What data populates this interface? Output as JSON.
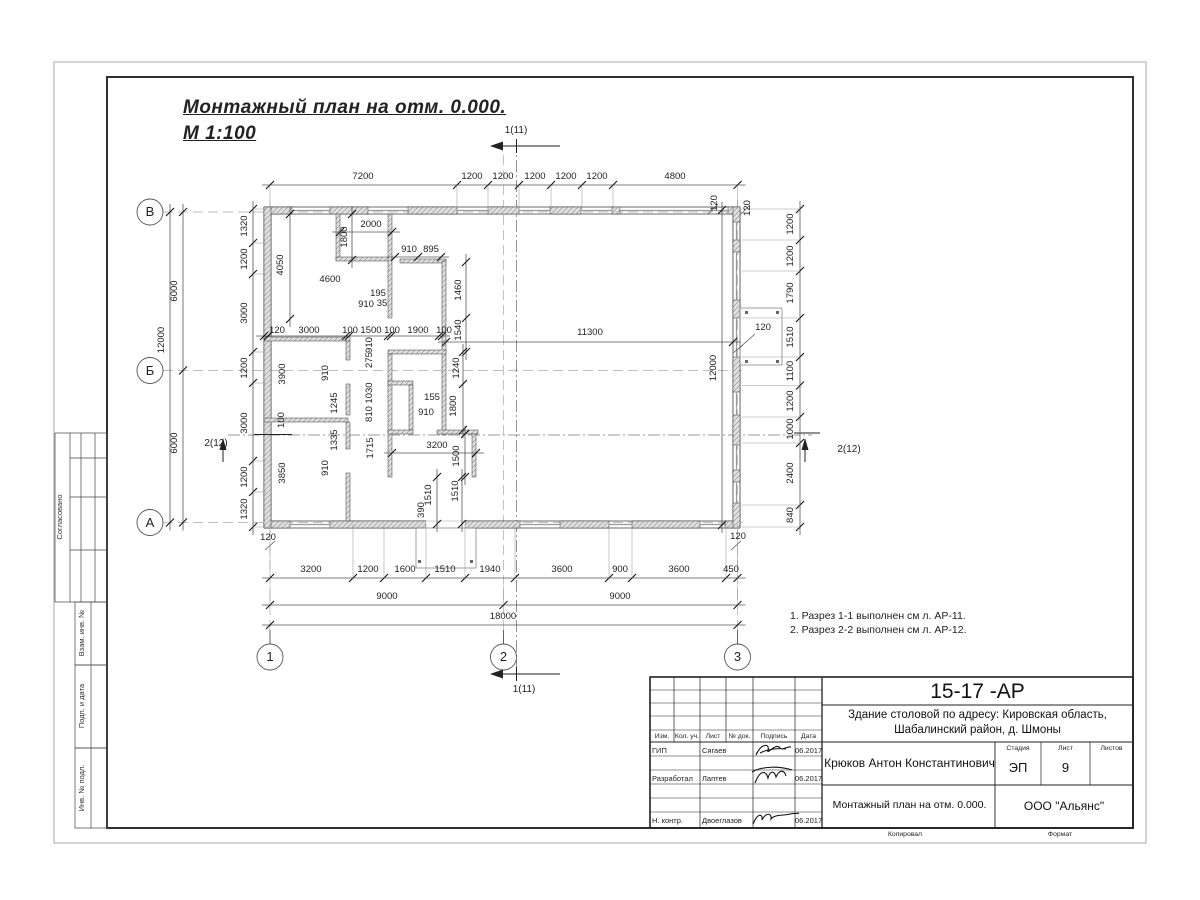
{
  "sheet": {
    "title": {
      "line1": "Монтажный план на отм. 0.000.",
      "line2": "М 1:100"
    },
    "notes": [
      "1. Разрез 1-1 выполнен см л. АР-11.",
      "2. Разрез 2-2 выполнен см л. АР-12."
    ],
    "side_labels": [
      "Согласовано",
      "Взам. инв. №",
      "Подп. и дата",
      "Инв. № подл."
    ],
    "stamp": {
      "code": "15-17 -АР",
      "object_line1": "Здание столовой по адресу: Кировская область,",
      "object_line2": "Шабалинский район, д. Шмоны",
      "person": "Крюков Антон Константинович",
      "doc_title": "Монтажный план на отм. 0.000.",
      "company": "ООО \"Альянс\"",
      "stage_label": "Стадия",
      "sheet_label": "Лист",
      "sheets_label": "Листов",
      "stage": "ЭП",
      "sheet_no": "9",
      "sheets": "",
      "cols": {
        "izm": "Изм.",
        "kol": "Кол. уч.",
        "list": "Лист",
        "doc": "№ док.",
        "sign": "Подпись",
        "date": "Дата"
      },
      "rows": [
        {
          "role": "ГИП",
          "name": "Сягаев",
          "date": "06.2017"
        },
        {
          "role": "Разработал",
          "name": "Лаптев",
          "date": "06.2017"
        },
        {
          "role": "Н. контр.",
          "name": "Двоеглазов",
          "date": "06.2017"
        }
      ],
      "kopiroval": "Копировал",
      "format": "Формат"
    }
  },
  "plan": {
    "colors": {
      "line": "#1a1a1a",
      "dim": "#444444",
      "wall_hatch": "#8a8a8a",
      "axis_dash": "#aaaaaa"
    },
    "labels": [
      {
        "t": "7200",
        "x": 363,
        "y": 179
      },
      {
        "t": "1200",
        "x": 472,
        "y": 179
      },
      {
        "t": "1200",
        "x": 503,
        "y": 179
      },
      {
        "t": "1200",
        "x": 535,
        "y": 179
      },
      {
        "t": "1200",
        "x": 566,
        "y": 179
      },
      {
        "t": "1200",
        "x": 597,
        "y": 179
      },
      {
        "t": "4800",
        "x": 675,
        "y": 179
      },
      {
        "t": "120",
        "x": 717,
        "y": 203,
        "r": -90
      },
      {
        "t": "120",
        "x": 750,
        "y": 208,
        "r": -90
      },
      {
        "t": "3200",
        "x": 311,
        "y": 572
      },
      {
        "t": "1200",
        "x": 368,
        "y": 572
      },
      {
        "t": "1600",
        "x": 405,
        "y": 572
      },
      {
        "t": "1510",
        "x": 445,
        "y": 572
      },
      {
        "t": "1940",
        "x": 490,
        "y": 572
      },
      {
        "t": "3600",
        "x": 562,
        "y": 572
      },
      {
        "t": "900",
        "x": 620,
        "y": 572
      },
      {
        "t": "3600",
        "x": 679,
        "y": 572
      },
      {
        "t": "450",
        "x": 731,
        "y": 572
      },
      {
        "t": "9000",
        "x": 387,
        "y": 599
      },
      {
        "t": "9000",
        "x": 620,
        "y": 599
      },
      {
        "t": "18000",
        "x": 503,
        "y": 619
      },
      {
        "t": "1320",
        "x": 247,
        "y": 226,
        "r": -90
      },
      {
        "t": "1200",
        "x": 247,
        "y": 259,
        "r": -90
      },
      {
        "t": "3000",
        "x": 247,
        "y": 313,
        "r": -90
      },
      {
        "t": "1200",
        "x": 247,
        "y": 368,
        "r": -90
      },
      {
        "t": "3000",
        "x": 247,
        "y": 423,
        "r": -90
      },
      {
        "t": "1200",
        "x": 247,
        "y": 477,
        "r": -90
      },
      {
        "t": "1320",
        "x": 247,
        "y": 509,
        "r": -90
      },
      {
        "t": "6000",
        "x": 177,
        "y": 291,
        "r": -90
      },
      {
        "t": "12000",
        "x": 164,
        "y": 340,
        "r": -90
      },
      {
        "t": "6000",
        "x": 177,
        "y": 443,
        "r": -90
      },
      {
        "t": "1200",
        "x": 793,
        "y": 224,
        "r": -90
      },
      {
        "t": "1200",
        "x": 793,
        "y": 256,
        "r": -90
      },
      {
        "t": "1790",
        "x": 793,
        "y": 293,
        "r": -90
      },
      {
        "t": "1510",
        "x": 793,
        "y": 337,
        "r": -90
      },
      {
        "t": "1100",
        "x": 793,
        "y": 371,
        "r": -90
      },
      {
        "t": "1200",
        "x": 793,
        "y": 401,
        "r": -90
      },
      {
        "t": "1000",
        "x": 793,
        "y": 429,
        "r": -90
      },
      {
        "t": "2400",
        "x": 793,
        "y": 473,
        "r": -90
      },
      {
        "t": "840",
        "x": 793,
        "y": 515,
        "r": -90
      },
      {
        "t": "120",
        "x": 268,
        "y": 540
      },
      {
        "t": "120",
        "x": 738,
        "y": 539
      },
      {
        "t": "2000",
        "x": 371,
        "y": 227
      },
      {
        "t": "1800",
        "x": 347,
        "y": 237,
        "r": -90
      },
      {
        "t": "4050",
        "x": 283,
        "y": 265,
        "r": -90
      },
      {
        "t": "4600",
        "x": 330,
        "y": 282
      },
      {
        "t": "910",
        "x": 409,
        "y": 252
      },
      {
        "t": "895",
        "x": 431,
        "y": 252
      },
      {
        "t": "1460",
        "x": 461,
        "y": 290,
        "r": -90
      },
      {
        "t": "1540",
        "x": 461,
        "y": 330,
        "r": -90
      },
      {
        "t": "195",
        "x": 378,
        "y": 296
      },
      {
        "t": "910",
        "x": 366,
        "y": 307
      },
      {
        "t": "35",
        "x": 382,
        "y": 306
      },
      {
        "t": "120",
        "x": 277,
        "y": 333
      },
      {
        "t": "3000",
        "x": 309,
        "y": 333
      },
      {
        "t": "100",
        "x": 350,
        "y": 333
      },
      {
        "t": "1500",
        "x": 371,
        "y": 333
      },
      {
        "t": "100",
        "x": 392,
        "y": 333
      },
      {
        "t": "1900",
        "x": 418,
        "y": 333
      },
      {
        "t": "100",
        "x": 444,
        "y": 333
      },
      {
        "t": "11300",
        "x": 590,
        "y": 335
      },
      {
        "t": "12000",
        "x": 716,
        "y": 368,
        "r": -90
      },
      {
        "t": "120",
        "x": 763,
        "y": 330
      },
      {
        "t": "910",
        "x": 372,
        "y": 345,
        "r": -90
      },
      {
        "t": "275",
        "x": 372,
        "y": 360,
        "r": -90
      },
      {
        "t": "1030",
        "x": 372,
        "y": 393,
        "r": -90
      },
      {
        "t": "810",
        "x": 372,
        "y": 414,
        "r": -90
      },
      {
        "t": "1715",
        "x": 373,
        "y": 448,
        "r": -90
      },
      {
        "t": "3900",
        "x": 285,
        "y": 374,
        "r": -90
      },
      {
        "t": "910",
        "x": 328,
        "y": 373,
        "r": -90
      },
      {
        "t": "1245",
        "x": 337,
        "y": 403,
        "r": -90
      },
      {
        "t": "100",
        "x": 284,
        "y": 420,
        "r": -90
      },
      {
        "t": "1335",
        "x": 337,
        "y": 440,
        "r": -90
      },
      {
        "t": "910",
        "x": 328,
        "y": 468,
        "r": -90
      },
      {
        "t": "3850",
        "x": 285,
        "y": 473,
        "r": -90
      },
      {
        "t": "1240",
        "x": 459,
        "y": 368,
        "r": -90
      },
      {
        "t": "1800",
        "x": 456,
        "y": 406,
        "r": -90
      },
      {
        "t": "155",
        "x": 432,
        "y": 400
      },
      {
        "t": "910",
        "x": 426,
        "y": 415
      },
      {
        "t": "3200",
        "x": 437,
        "y": 448
      },
      {
        "t": "1500",
        "x": 459,
        "y": 456,
        "r": -90
      },
      {
        "t": "1510",
        "x": 431,
        "y": 495,
        "r": -90
      },
      {
        "t": "1510",
        "x": 458,
        "y": 491,
        "r": -90
      },
      {
        "t": "390",
        "x": 424,
        "y": 510,
        "r": -90
      },
      {
        "t": "В",
        "x": 150,
        "y": 216,
        "c": "ax",
        "n": "axis-label-v"
      },
      {
        "t": "Б",
        "x": 150,
        "y": 375,
        "c": "ax",
        "n": "axis-label-b"
      },
      {
        "t": "А",
        "x": 150,
        "y": 527,
        "c": "ax",
        "n": "axis-label-a"
      },
      {
        "t": "1",
        "x": 270,
        "y": 661,
        "c": "ax",
        "n": "axis-label-1"
      },
      {
        "t": "2",
        "x": 503.5,
        "y": 661,
        "c": "ax",
        "n": "axis-label-2"
      },
      {
        "t": "3",
        "x": 737.5,
        "y": 661,
        "c": "ax",
        "n": "axis-label-3"
      },
      {
        "t": "1(11)",
        "x": 516,
        "y": 133,
        "c": "sec",
        "n": "section-mark-label"
      },
      {
        "t": "1(11)",
        "x": 524,
        "y": 692,
        "c": "sec",
        "n": "section-mark-label"
      },
      {
        "t": "2(12)",
        "x": 216,
        "y": 446,
        "c": "sec",
        "n": "section-mark-label"
      },
      {
        "t": "2(12)",
        "x": 849,
        "y": 452,
        "c": "sec",
        "n": "section-mark-label"
      },
      {
        "t": "Согласовано",
        "x": 62,
        "y": 517,
        "r": -90,
        "c": "sm",
        "n": "side-label"
      },
      {
        "t": "Взам. инв. №",
        "x": 84,
        "y": 633,
        "r": -90,
        "c": "sm",
        "n": "side-label"
      },
      {
        "t": "Подп. и дата",
        "x": 84,
        "y": 706,
        "r": -90,
        "c": "sm",
        "n": "side-label"
      },
      {
        "t": "Инв. № подл.",
        "x": 84,
        "y": 788,
        "r": -90,
        "c": "sm",
        "n": "side-label"
      }
    ],
    "chains": [
      {
        "o": "h",
        "pos": 185,
        "pts": [
          270,
          457,
          488,
          519,
          551,
          582,
          613,
          737.5
        ],
        "ext": 209
      },
      {
        "o": "h",
        "pos": 578,
        "pts": [
          270,
          353,
          384,
          426,
          465,
          515,
          609,
          632,
          726,
          737.5
        ],
        "ext": 524
      },
      {
        "o": "h",
        "pos": 605,
        "pts": [
          270,
          503.5,
          737.5
        ],
        "ext": 586
      },
      {
        "o": "h",
        "pos": 625,
        "pts": [
          270,
          737.5
        ],
        "ext": 0
      },
      {
        "o": "v",
        "pos": 253,
        "pts": [
          209,
          243,
          274,
          352,
          383,
          461,
          492,
          527
        ],
        "ext": 266
      },
      {
        "o": "v",
        "pos": 183,
        "pts": [
          212,
          370.5,
          522.5
        ],
        "ext": 0
      },
      {
        "o": "v",
        "pos": 170,
        "pts": [
          212,
          522.5
        ],
        "ext": 0
      },
      {
        "o": "v",
        "pos": 800,
        "pts": [
          209,
          240,
          271,
          318,
          357,
          385.5,
          417,
          443,
          505,
          527
        ],
        "ext": 742
      },
      {
        "o": "h",
        "pos": 336,
        "pts": [
          264,
          268,
          346,
          349,
          388,
          391,
          439,
          442
        ],
        "ext": 0
      },
      {
        "o": "h",
        "pos": 342,
        "pts": [
          446,
          733
        ],
        "ext": 0
      },
      {
        "o": "v",
        "pos": 722,
        "pts": [
          210,
          525
        ],
        "ext": 0
      },
      {
        "o": "h",
        "pos": 232,
        "pts": [
          340,
          392
        ],
        "ext": 0
      },
      {
        "o": "v",
        "pos": 352,
        "pts": [
          214,
          260
        ],
        "ext": 0
      },
      {
        "o": "v",
        "pos": 290,
        "pts": [
          214,
          319
        ],
        "ext": 0
      },
      {
        "o": "h",
        "pos": 257,
        "pts": [
          395,
          418,
          441
        ],
        "ext": 0
      },
      {
        "o": "v",
        "pos": 466,
        "pts": [
          262,
          318,
          352
        ],
        "ext": 0
      },
      {
        "o": "v",
        "pos": 463,
        "pts": [
          352,
          384,
          430
        ],
        "ext": 0
      },
      {
        "o": "h",
        "pos": 453,
        "pts": [
          392,
          476
        ],
        "ext": 0
      },
      {
        "o": "v",
        "pos": 465,
        "pts": [
          434,
          477
        ],
        "ext": 0
      },
      {
        "o": "v",
        "pos": 437,
        "pts": [
          477,
          524
        ],
        "ext": 0
      },
      {
        "o": "v",
        "pos": 462,
        "pts": [
          477,
          524
        ],
        "ext": 0
      }
    ]
  }
}
